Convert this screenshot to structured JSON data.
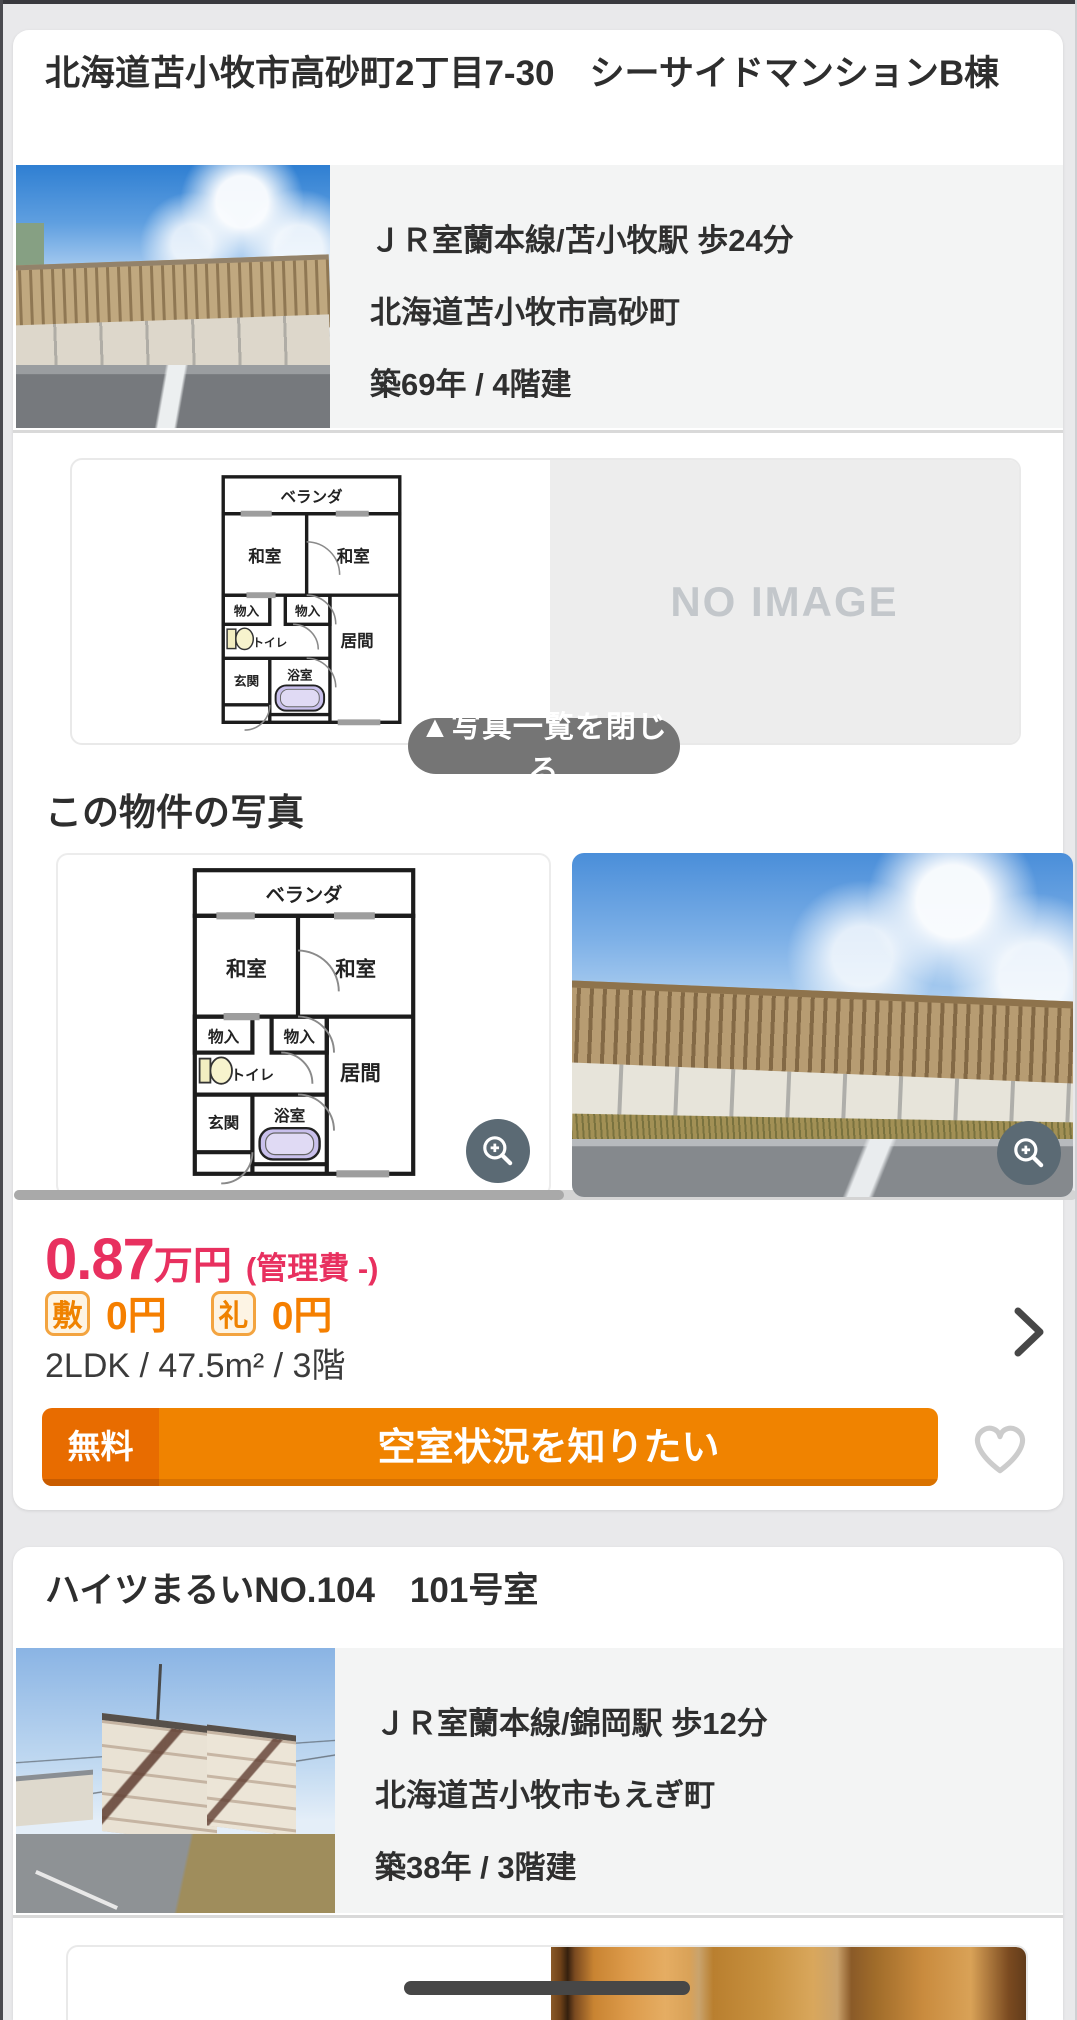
{
  "colors": {
    "page-bg": "#e9e9eb",
    "text-dark": "#2e2e2e",
    "info-bg": "#f3f4f4",
    "divider": "#d9d9d9",
    "pink": "#e8305f",
    "orange": "#f08300",
    "orange-dark": "#e86c00",
    "orange-text": "#f57f00",
    "badge-border": "#f3a440",
    "badge-bg": "#fdf4e4",
    "gray-btn": "#757575",
    "slate": "#5b6a74",
    "noimg-bg": "#ededed",
    "noimg-text": "#c3c7cb",
    "heart": "#cccccc",
    "thumb": "#a9a9a9",
    "track": "#d4d4d4",
    "indicator": "#474747"
  },
  "listing1": {
    "title": "北海道苫小牧市高砂町2丁目7-30　シーサイドマンションB棟",
    "access": "ＪＲ室蘭本線/苫小牧駅 歩24分",
    "address": "北海道苫小牧市高砂町",
    "age_floors": "築69年 / 4階建",
    "viewer": {
      "no_image": "NO IMAGE",
      "close_button": "▲写真一覧を閉じる"
    },
    "photos_heading": "この物件の写真",
    "price": {
      "amount": "0.87",
      "unit": "万円",
      "admin_fee": "(管理費 -)"
    },
    "fees": {
      "deposit_badge": "敷",
      "deposit": "0円",
      "key_badge": "礼",
      "key": "0円"
    },
    "specs": "2LDK /  47.5m² /  3階",
    "cta": {
      "tag": "無料",
      "label": "空室状況を知りたい"
    }
  },
  "listing2": {
    "title": "ハイツまるいNO.104　101号室",
    "access": "ＪＲ室蘭本線/錦岡駅 歩12分",
    "address": "北海道苫小牧市もえぎ町",
    "age_floors": "築38年 / 3階建"
  },
  "floorplan": {
    "veranda": "ベランダ",
    "tatami_a": "和室",
    "tatami_b": "和室",
    "closet_a": "物入",
    "closet_b": "物入",
    "toilet": "トイレ",
    "living": "居間",
    "entrance": "玄関",
    "bath": "浴室"
  }
}
